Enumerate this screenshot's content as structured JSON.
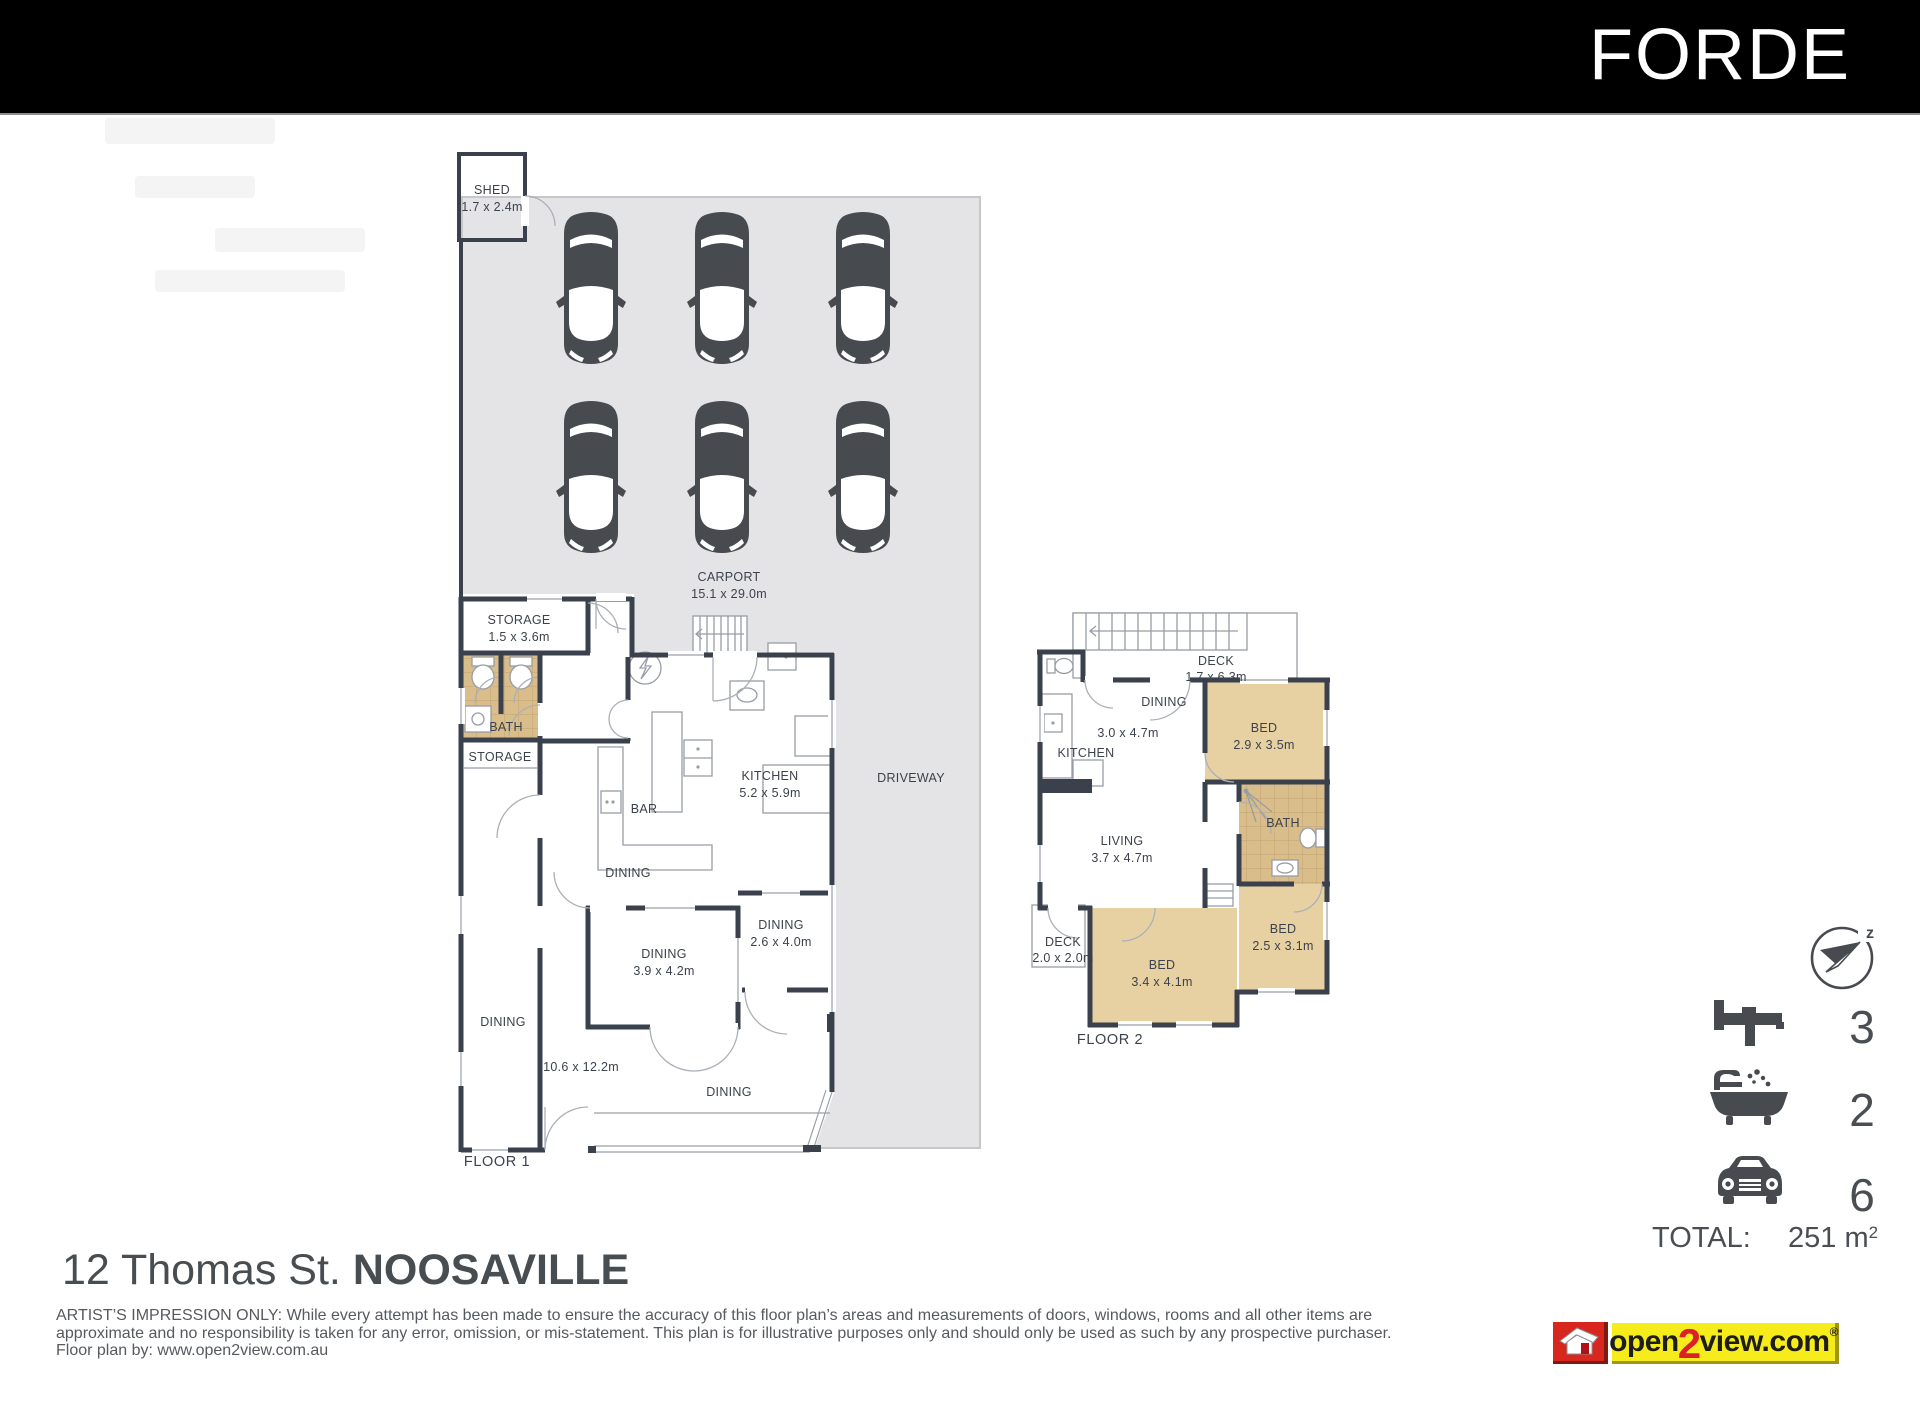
{
  "header": {
    "brand": "FORDE"
  },
  "plan": {
    "floor1": {
      "title": "FLOOR 1",
      "shed_label": "SHED",
      "shed_dims": "1.7 x 2.4m",
      "carport_label": "CARPORT",
      "carport_dims": "15.1 x 29.0m",
      "driveway_label": "DRIVEWAY",
      "storage1_label": "STORAGE",
      "storage1_dims": "1.5 x 3.6m",
      "bath_label": "BATH",
      "storage2_label": "STORAGE",
      "kitchen_label": "KITCHEN",
      "kitchen_dims": "5.2 x 5.9m",
      "bar_label": "BAR",
      "dining_top_label": "DINING",
      "dining_main_label": "DINING",
      "dining_main_dims": "3.9 x 4.2m",
      "dining_right_label": "DINING",
      "dining_right_dims": "2.6 x 4.0m",
      "dining_left_label": "DINING",
      "dining_bottom_label": "DINING",
      "overall_dims": "10.6 x 12.2m"
    },
    "floor2": {
      "title": "FLOOR 2",
      "deck_top_label": "DECK",
      "deck_top_dims": "1.7 x 6.3m",
      "dining_label": "DINING",
      "dining_dims": "3.0 x 4.7m",
      "kitchen_label": "KITCHEN",
      "bed1_label": "BED",
      "bed1_dims": "2.9 x 3.5m",
      "bath_label": "BATH",
      "living_label": "LIVING",
      "living_dims": "3.7 x 4.7m",
      "deck_left_label": "DECK",
      "deck_left_dims": "2.0 x 2.0m",
      "bed2_label": "BED",
      "bed2_dims": "3.4 x 4.1m",
      "bed3_label": "BED",
      "bed3_dims": "2.5 x 3.1m"
    }
  },
  "stats": {
    "compass_icon": "compass-north-icon",
    "compass_mark": "z",
    "rows": [
      {
        "icon": "bed-icon",
        "value": "3"
      },
      {
        "icon": "bath-icon",
        "value": "2"
      },
      {
        "icon": "car-icon",
        "value": "6"
      }
    ],
    "total_label": "TOTAL:",
    "total_value": "251 m",
    "total_sup": "2"
  },
  "address": {
    "street": "12 Thomas St.",
    "suburb": "NOOSAVILLE"
  },
  "disclaimer": {
    "line1": "ARTIST’S IMPRESSION ONLY: While every attempt has been made to ensure the accuracy of this floor plan’s areas and measurements of doors, windows, rooms and all other items are",
    "line2": "approximate and no responsibility is taken for any error, omission, or mis-statement. This plan is for illustrative purposes only and should only be used as such by any prospective purchaser.",
    "line3": "Floor plan by: www.open2view.com.au"
  },
  "logo": {
    "open": "open",
    "two": "2",
    "view": "view.com",
    "reg": "®"
  },
  "colors": {
    "wall": "#3a414d",
    "carport_fill": "#e4e4e6",
    "car": "#474b50",
    "bedroom_fill": "#e7d1a3",
    "bath_fill": "#d9bd8a",
    "logo_red": "#d8271f",
    "logo_yellow": "#f6ec1c",
    "accent_red": "#da2128"
  }
}
